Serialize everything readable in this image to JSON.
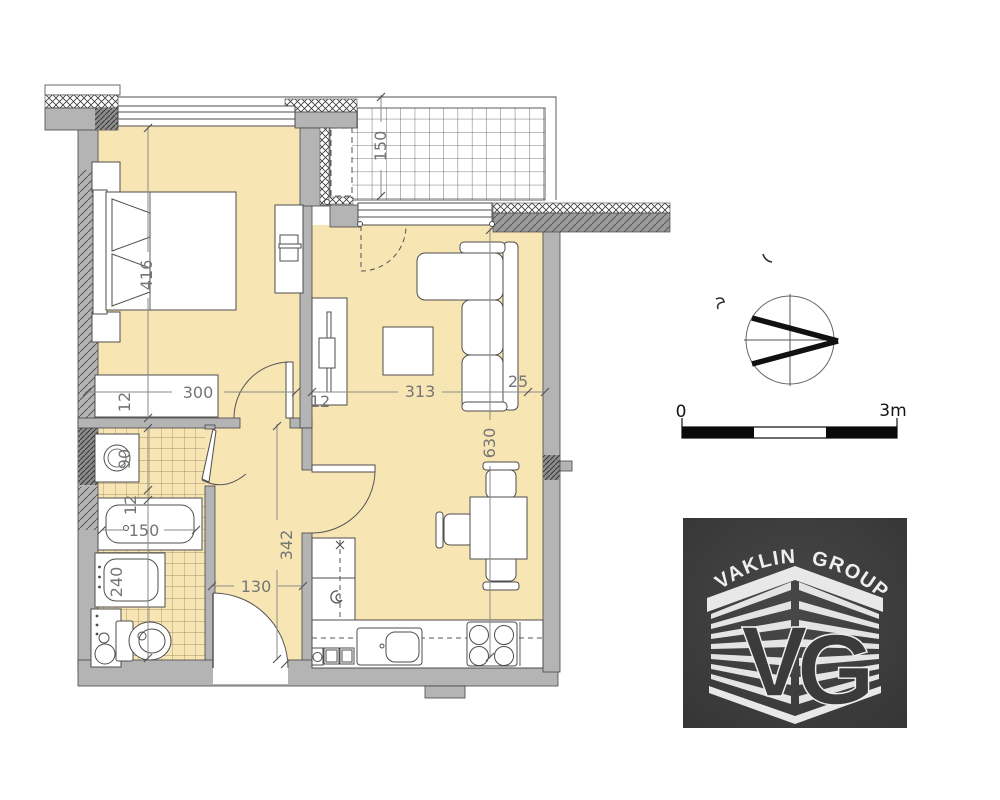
{
  "title": "apartment-floor-plan",
  "dimensions": {
    "bedroom_length": "416",
    "balcony_depth": "150",
    "bedroom_width": "300",
    "wall_bedroom_living": "12",
    "living_width": "313",
    "sofa_offset": "25",
    "living_length": "630",
    "hallway_length": "342",
    "hallway_width": "130",
    "washer_width": "90",
    "wall_bedroom_bath": "12",
    "wall_bath_mid": "12",
    "bathtub_length": "150",
    "bath_lower_length": "240"
  },
  "scale_bar": {
    "start_label": "0",
    "end_label": "3m"
  },
  "logo": {
    "word1": "VAKLIN",
    "word2": "GROUP",
    "letter_v": "V",
    "letter_g": "G"
  }
}
